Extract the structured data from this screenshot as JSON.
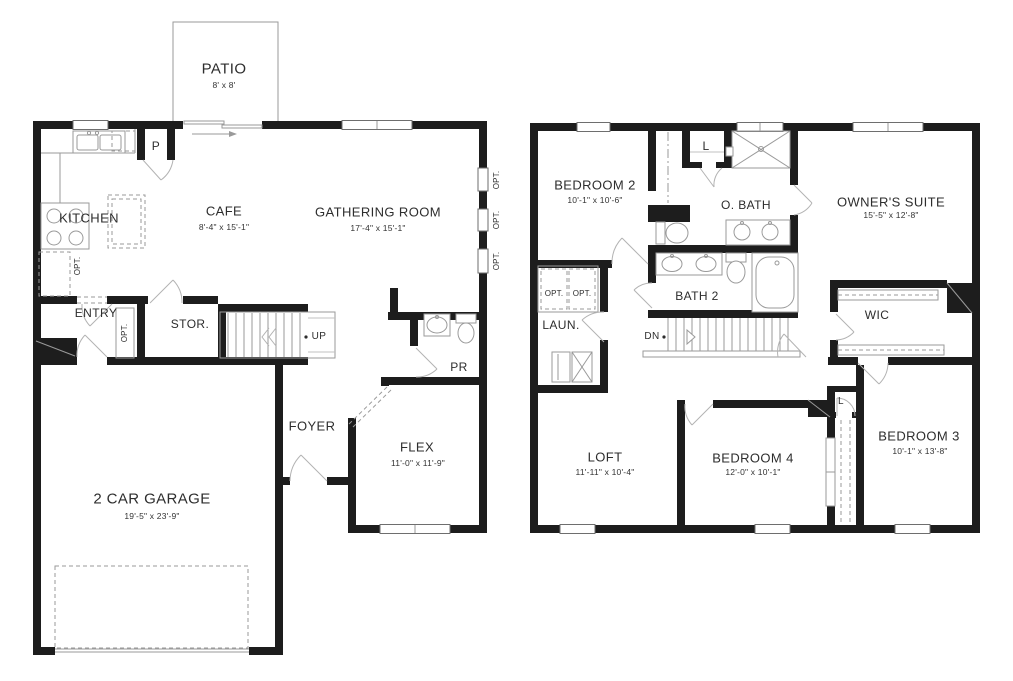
{
  "shared": {
    "opt_label": "OPT.",
    "linen_label": "L",
    "up_label": "UP",
    "dn_label": "DN"
  },
  "floor1": {
    "patio": {
      "name": "PATIO",
      "dims": "8' x 8'"
    },
    "kitchen": {
      "name": "KITCHEN"
    },
    "pantry": {
      "name": "P"
    },
    "cafe": {
      "name": "CAFE",
      "dims": "8'-4\" x 15'-1\""
    },
    "gathering_room": {
      "name": "GATHERING ROOM",
      "dims": "17'-4\" x 15'-1\""
    },
    "entry": {
      "name": "ENTRY"
    },
    "storage": {
      "name": "STOR."
    },
    "powder_room": {
      "name": "PR"
    },
    "foyer": {
      "name": "FOYER"
    },
    "flex": {
      "name": "FLEX",
      "dims": "11'-0\" x 11'-9\""
    },
    "garage": {
      "name": "2 CAR GARAGE",
      "dims": "19'-5\" x 23'-9\""
    }
  },
  "floor2": {
    "bedroom2": {
      "name": "BEDROOM 2",
      "dims": "10'-1\" x 10'-6\""
    },
    "owners_bath": {
      "name": "O. BATH"
    },
    "owners_suite": {
      "name": "OWNER'S SUITE",
      "dims": "15'-5\" x 12'-8\""
    },
    "laundry": {
      "name": "LAUN."
    },
    "bath2": {
      "name": "BATH 2"
    },
    "wic": {
      "name": "WIC"
    },
    "loft": {
      "name": "LOFT",
      "dims": "11'-11\" x 10'-4\""
    },
    "bedroom4": {
      "name": "BEDROOM 4",
      "dims": "12'-0\" x 10'-1\""
    },
    "bedroom3": {
      "name": "BEDROOM 3",
      "dims": "10'-1\" x 13'-8\""
    }
  },
  "colors": {
    "wall": "#1d1d1d",
    "thin_line": "#9a9a9a",
    "text": "#2d2d2d"
  }
}
